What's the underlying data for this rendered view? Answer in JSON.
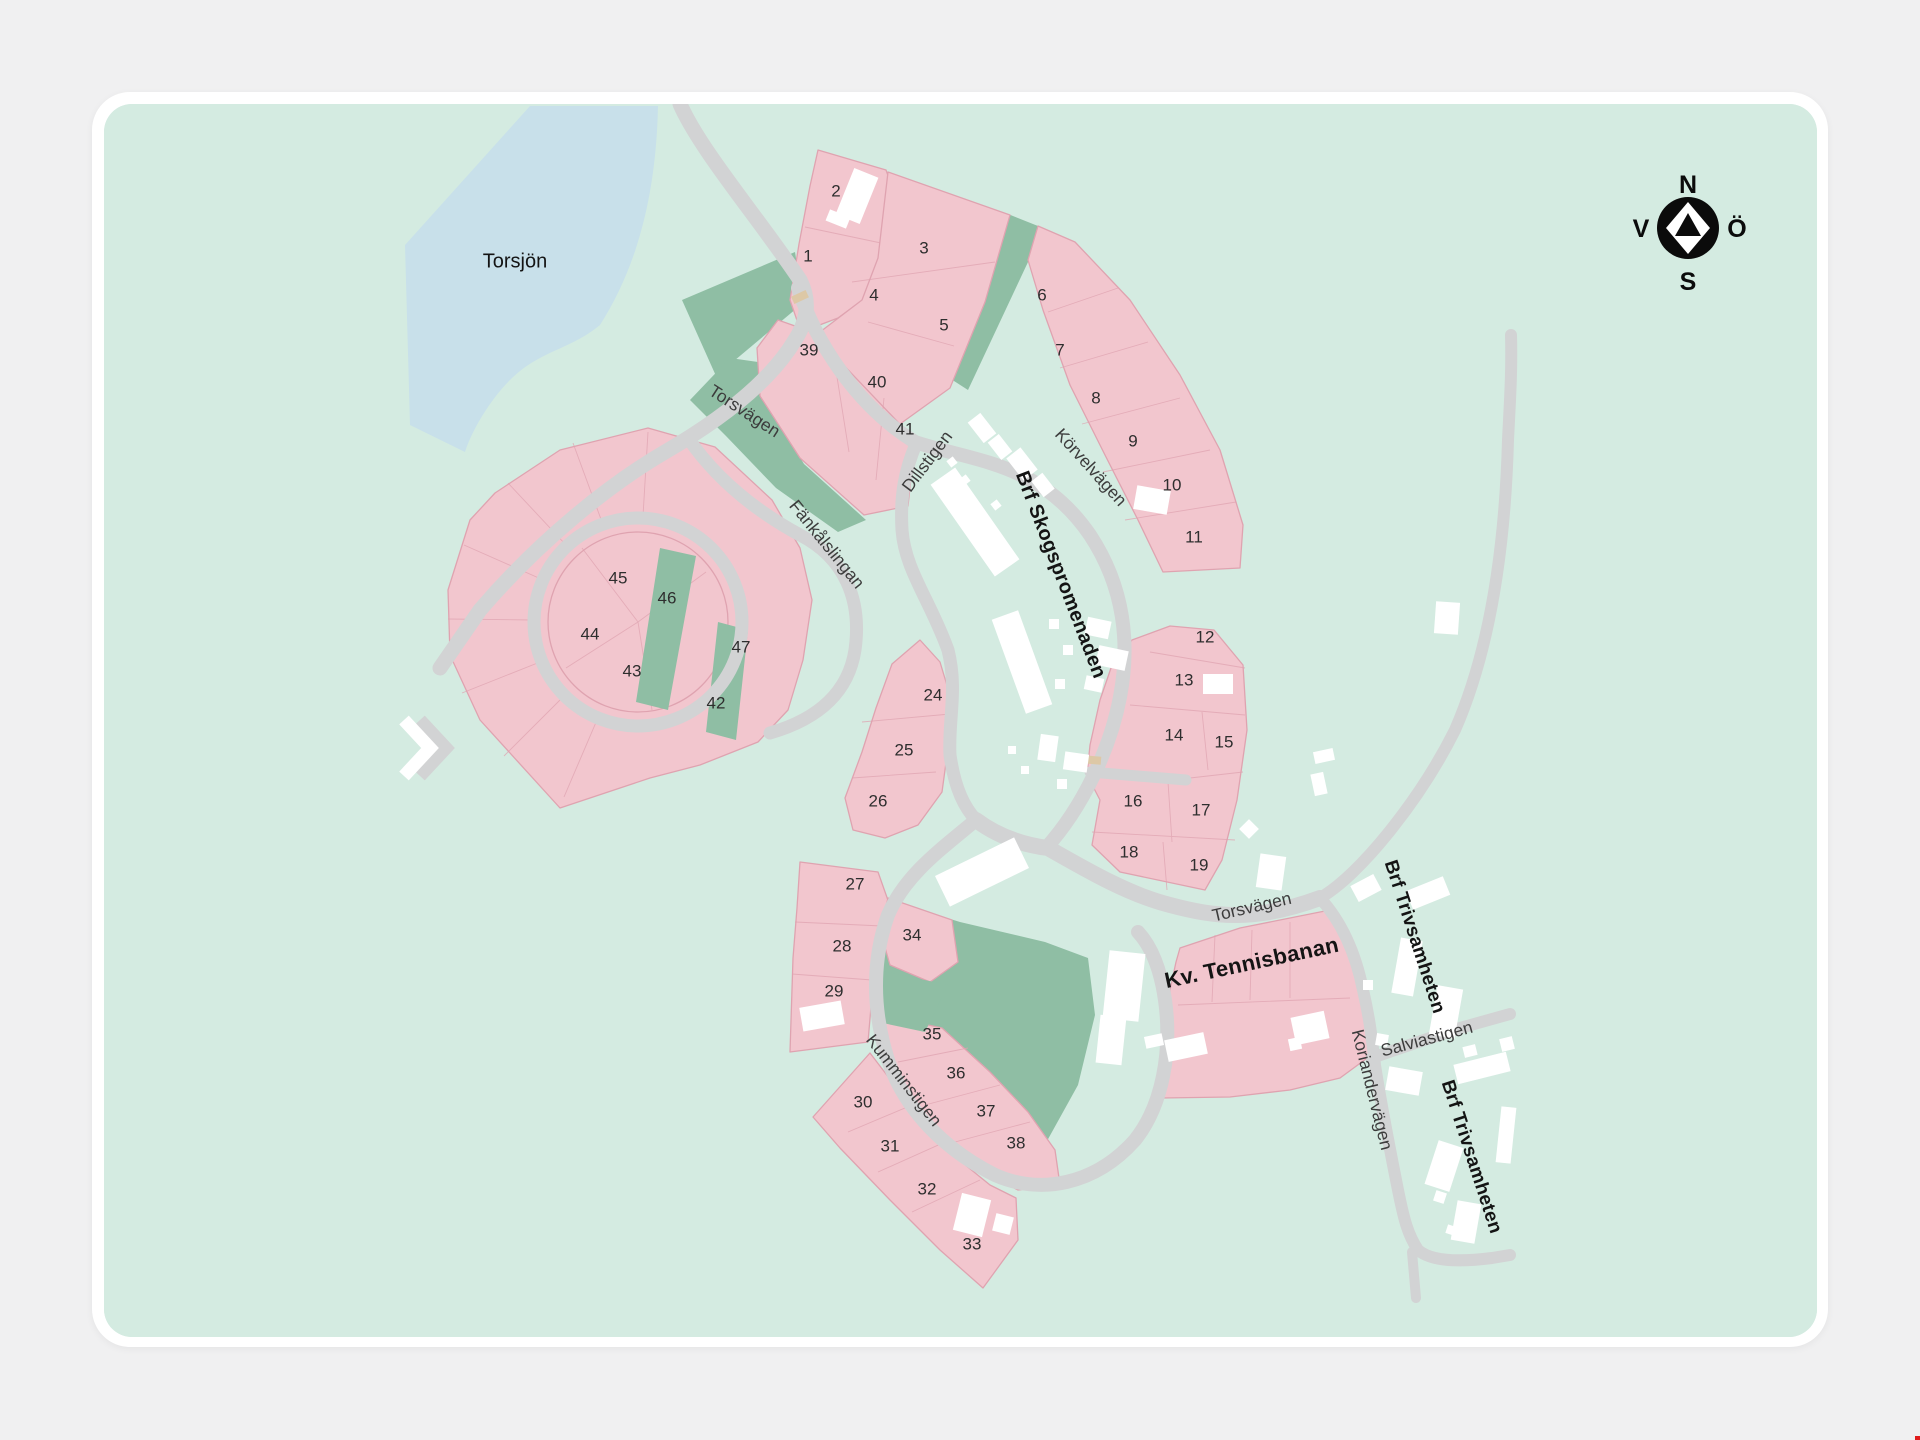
{
  "compass": {
    "north": "N",
    "south": "S",
    "west": "V",
    "east": "Ö"
  },
  "areas": [
    {
      "id": "lake-name",
      "label": "Torsjön",
      "x": 515,
      "y": 262,
      "rot": 0,
      "size": 20,
      "bold": false
    },
    {
      "id": "brf-skogspromenaden",
      "label": "Brf Skogspromenaden",
      "x": 1060,
      "y": 575,
      "rot": 69,
      "size": 20,
      "bold": true
    },
    {
      "id": "kv-tennisbanan",
      "label": "Kv. Tennisbanan",
      "x": 1252,
      "y": 964,
      "rot": -12,
      "size": 22,
      "bold": true
    },
    {
      "id": "brf-trivsamheten-1",
      "label": "Brf Trivsamheten",
      "x": 1414,
      "y": 937,
      "rot": 72,
      "size": 19,
      "bold": true
    },
    {
      "id": "brf-trivsamheten-2",
      "label": "Brf Trivsamheten",
      "x": 1471,
      "y": 1157,
      "rot": 72,
      "size": 19,
      "bold": true
    }
  ],
  "streets": [
    {
      "id": "torsvagen-nw",
      "name": "Torsvägen",
      "x": 744,
      "y": 412,
      "rot": 33
    },
    {
      "id": "dillstigen",
      "name": "Dillstigen",
      "x": 928,
      "y": 462,
      "rot": -53
    },
    {
      "id": "korvelvagen",
      "name": "Körvelvägen",
      "x": 1090,
      "y": 468,
      "rot": 48
    },
    {
      "id": "fankalslingan",
      "name": "Fänkålslingan",
      "x": 826,
      "y": 545,
      "rot": 51
    },
    {
      "id": "kumminstigen",
      "name": "Kumminstigen",
      "x": 903,
      "y": 1081,
      "rot": 52
    },
    {
      "id": "torsvagen-e",
      "name": "Torsvägen",
      "x": 1252,
      "y": 908,
      "rot": -13
    },
    {
      "id": "salviastigen",
      "name": "Salviastigen",
      "x": 1427,
      "y": 1040,
      "rot": -15
    },
    {
      "id": "koriandervagen",
      "name": "Koriandervägen",
      "x": 1371,
      "y": 1090,
      "rot": 76
    }
  ],
  "lots": [
    {
      "n": "1",
      "x": 808,
      "y": 257
    },
    {
      "n": "2",
      "x": 836,
      "y": 192
    },
    {
      "n": "3",
      "x": 924,
      "y": 249
    },
    {
      "n": "4",
      "x": 874,
      "y": 296
    },
    {
      "n": "5",
      "x": 944,
      "y": 326
    },
    {
      "n": "6",
      "x": 1042,
      "y": 296
    },
    {
      "n": "7",
      "x": 1060,
      "y": 351
    },
    {
      "n": "8",
      "x": 1096,
      "y": 399
    },
    {
      "n": "9",
      "x": 1133,
      "y": 442
    },
    {
      "n": "10",
      "x": 1172,
      "y": 486
    },
    {
      "n": "11",
      "x": 1194,
      "y": 538
    },
    {
      "n": "12",
      "x": 1205,
      "y": 638
    },
    {
      "n": "13",
      "x": 1184,
      "y": 681
    },
    {
      "n": "14",
      "x": 1174,
      "y": 736
    },
    {
      "n": "15",
      "x": 1224,
      "y": 743
    },
    {
      "n": "16",
      "x": 1133,
      "y": 802
    },
    {
      "n": "17",
      "x": 1201,
      "y": 811
    },
    {
      "n": "18",
      "x": 1129,
      "y": 853
    },
    {
      "n": "19",
      "x": 1199,
      "y": 866
    },
    {
      "n": "24",
      "x": 933,
      "y": 696
    },
    {
      "n": "25",
      "x": 904,
      "y": 751
    },
    {
      "n": "26",
      "x": 878,
      "y": 802
    },
    {
      "n": "27",
      "x": 855,
      "y": 885
    },
    {
      "n": "28",
      "x": 842,
      "y": 947
    },
    {
      "n": "29",
      "x": 834,
      "y": 992
    },
    {
      "n": "30",
      "x": 863,
      "y": 1103
    },
    {
      "n": "31",
      "x": 890,
      "y": 1147
    },
    {
      "n": "32",
      "x": 927,
      "y": 1190
    },
    {
      "n": "33",
      "x": 972,
      "y": 1245
    },
    {
      "n": "34",
      "x": 912,
      "y": 936
    },
    {
      "n": "35",
      "x": 932,
      "y": 1035
    },
    {
      "n": "36",
      "x": 956,
      "y": 1074
    },
    {
      "n": "37",
      "x": 986,
      "y": 1112
    },
    {
      "n": "38",
      "x": 1016,
      "y": 1144
    },
    {
      "n": "39",
      "x": 809,
      "y": 351
    },
    {
      "n": "40",
      "x": 877,
      "y": 383
    },
    {
      "n": "41",
      "x": 905,
      "y": 430
    },
    {
      "n": "42",
      "x": 716,
      "y": 704
    },
    {
      "n": "43",
      "x": 632,
      "y": 672
    },
    {
      "n": "44",
      "x": 590,
      "y": 635
    },
    {
      "n": "45",
      "x": 618,
      "y": 579
    },
    {
      "n": "46",
      "x": 667,
      "y": 599
    },
    {
      "n": "47",
      "x": 741,
      "y": 648
    }
  ],
  "colors": {
    "bg": "#f0f0f1",
    "card": "#ffffff",
    "mint": "#d4ebe1",
    "lake": "#c8e0ea",
    "road": "#d2d3d4",
    "pink": "#f2c6ce",
    "pinkline": "#dfa3b0",
    "green": "#8fbea4",
    "building": "#ffffff",
    "ink": "#2e2e2e",
    "street": "#3c3c3c",
    "tan": "#ddc8a6"
  }
}
